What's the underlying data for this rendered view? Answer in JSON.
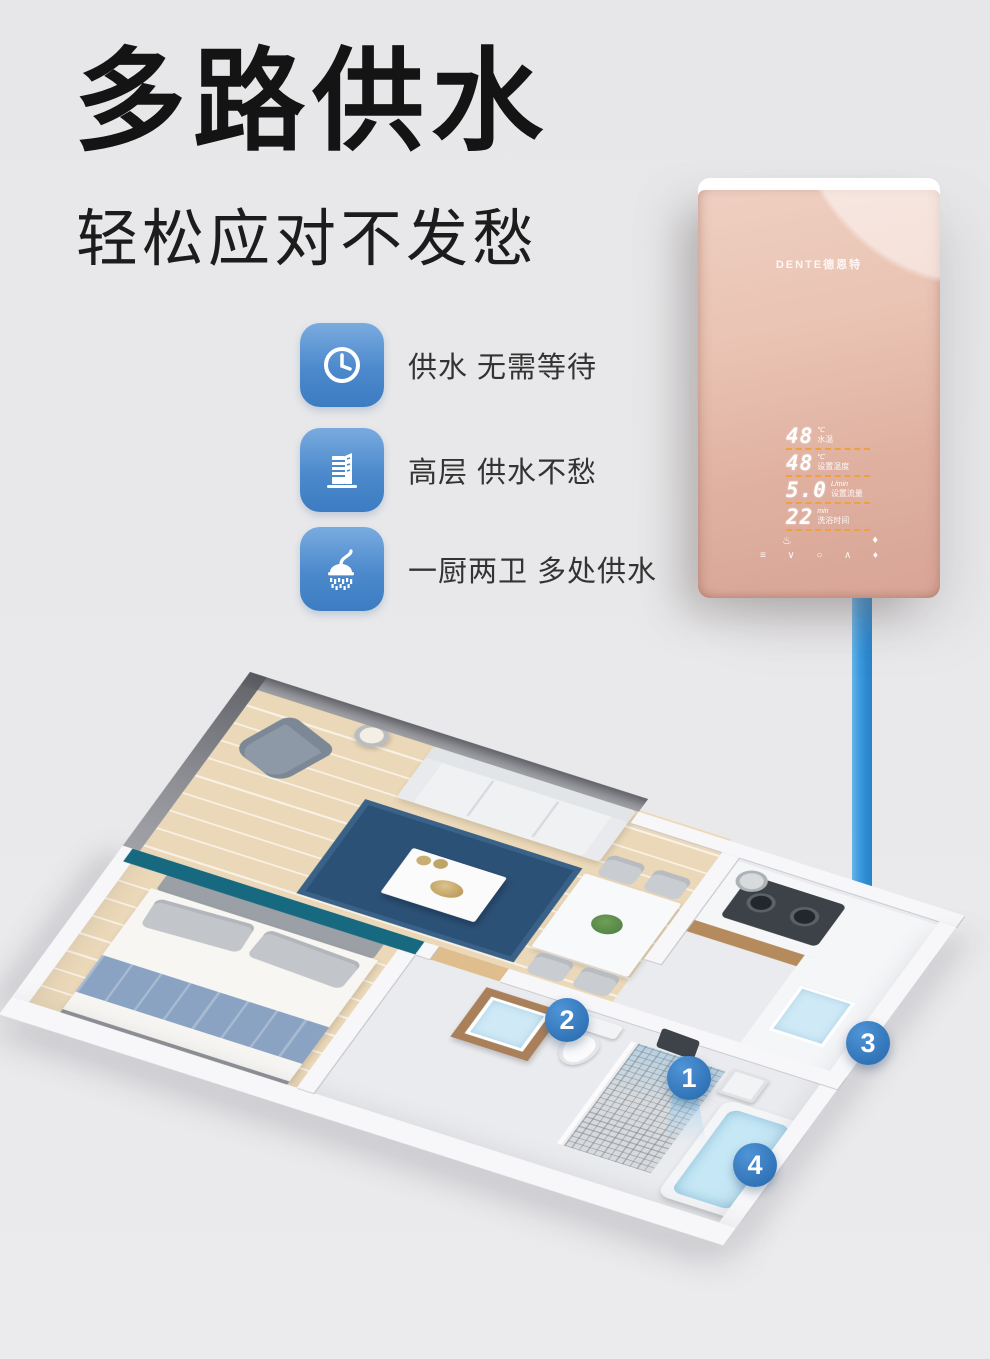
{
  "header": {
    "title": "多路供水",
    "subtitle": "轻松应对不发愁"
  },
  "features": [
    {
      "icon": "clock-icon",
      "text": "供水 无需等待"
    },
    {
      "icon": "building-icon",
      "text": "高层 供水不愁"
    },
    {
      "icon": "shower-icon",
      "text": "一厨两卫 多处供水"
    }
  ],
  "feature_icon_color": "#4c89cc",
  "heater": {
    "brand": "DENTE德恩特",
    "panel_color": "#e3b7a9",
    "display": {
      "divider_color": "#f0a03c",
      "rows": [
        {
          "value": "48",
          "unit": "℃",
          "label": "水温"
        },
        {
          "value": "48",
          "unit": "℃",
          "label": "设置温度"
        },
        {
          "value": "5.0",
          "unit": "L/min",
          "label": "设置流量"
        },
        {
          "value": "22",
          "unit": "min",
          "label": "洗浴时间"
        }
      ]
    },
    "indicators": [
      {
        "name": "shower-indicator-icon",
        "glyph": "♨"
      },
      {
        "name": "drop-indicator-icon",
        "glyph": "♦"
      }
    ],
    "controls": [
      {
        "name": "menu-icon",
        "glyph": "≡"
      },
      {
        "name": "down-icon",
        "glyph": "∨"
      },
      {
        "name": "power-icon",
        "glyph": "○"
      },
      {
        "name": "up-icon",
        "glyph": "∧"
      },
      {
        "name": "spray-icon",
        "glyph": "♦"
      }
    ]
  },
  "pipe": {
    "color": "#2f8fd6"
  },
  "floorplan": {
    "marker_color": "#3279c2",
    "markers": [
      "1",
      "2",
      "3",
      "4"
    ]
  }
}
